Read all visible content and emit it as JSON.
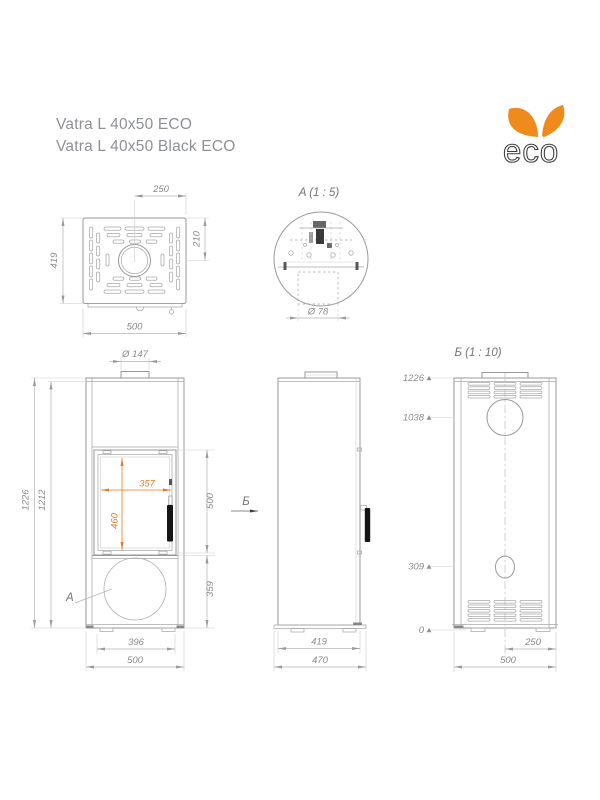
{
  "title": {
    "line1": "Vatra L 40x50 ECO",
    "line2": "Vatra L 40x50 Black ECO"
  },
  "logo": {
    "text": "eco"
  },
  "colors": {
    "accent_dim_orange": "#e87a25",
    "logo_leaf_orange": "#ef8a1c",
    "drawing_line_gray": "#999999",
    "dim_text_gray": "#8a8a8a",
    "handle_black": "#151515"
  },
  "top_view": {
    "dim_flue_offset": "250",
    "dim_depth": "419",
    "dim_flue_from_front": "210",
    "dim_width": "500"
  },
  "detail_a": {
    "label": "A (1 : 5)",
    "dim_diameter": "Ø 78"
  },
  "front_view": {
    "dim_collar": "Ø 147",
    "dim_height_total": "1226",
    "dim_height_body": "1212",
    "dim_glass_width": "357",
    "dim_glass_height": "460",
    "dim_door_height": "500",
    "dim_base_height": "359",
    "dim_feet_width": "396",
    "dim_width": "500",
    "callout_label": "A"
  },
  "side_view": {
    "view_arrow_label": "Б",
    "dim_depth_body": "419",
    "dim_depth_total": "470"
  },
  "back_view": {
    "label": "Б (1 : 10)",
    "elevations": [
      "1226",
      "1038",
      "309",
      "0"
    ],
    "dim_flue_offset": "250",
    "dim_width": "500"
  }
}
